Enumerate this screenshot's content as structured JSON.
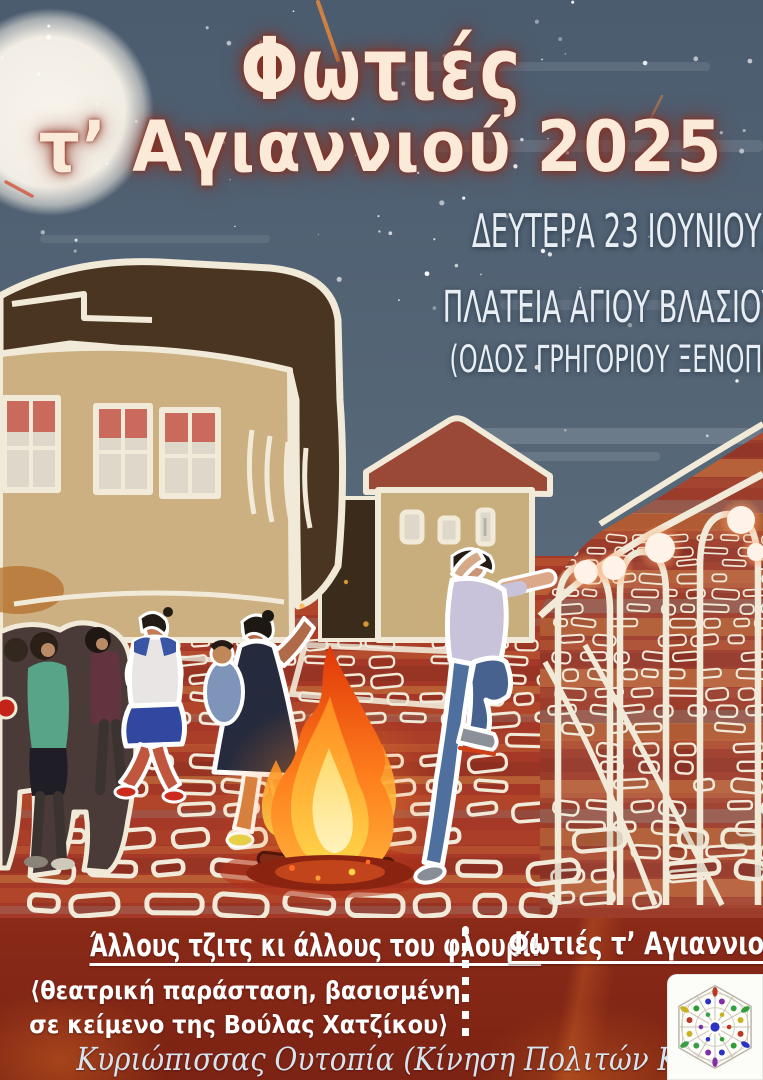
{
  "poster": {
    "title": {
      "line1": "Φωτιές",
      "line2": "τ’ Αγιαννιού 2025"
    },
    "event": {
      "datetime": "ΔΕΥΤΕΡΑ 23 ΙΟΥΝΙΟΥ, 21:30,",
      "venue": "ΠΛΑΤΕΙΑ ΑΓΙΟΥ ΒΛΑΣΙΟΥ",
      "street": "(ΟΔΟΣ ΓΡΗΓΟΡΙΟΥ ΞΕΝΟΠΟΥΛΟΥ)"
    },
    "footer": {
      "play_title": "Άλλους τζιτς κι άλλους του φλουρί!",
      "play_sub1": "⟨θεατρική παράσταση, βασισμένη",
      "play_sub2": "σε κείμενο της Βούλας Χατζίκου⟩",
      "event_name": "Φωτιές τ’ Αγιαννιού",
      "credit": "Κυριώπισσας Ουτοπία (Κίνηση Πολιτών Κυριώπισσας)",
      "logo_icon": "hexagonal-rosette-logo"
    },
    "illustration_icons": {
      "moon": "full-moon",
      "bonfire": "bonfire",
      "scene": "people-running-and-jumping-over-fire-in-village-square"
    },
    "colors": {
      "sky": "#56677a",
      "title_text": "#fcead9",
      "title_glow": "#8a2f1f",
      "detail_text": "#e8eef3",
      "ground": "#a53827",
      "band": "#8a2a19",
      "footer_text": "#ffffff",
      "credit_text": "#d5e4ef",
      "outline": "#f2ead9"
    }
  }
}
